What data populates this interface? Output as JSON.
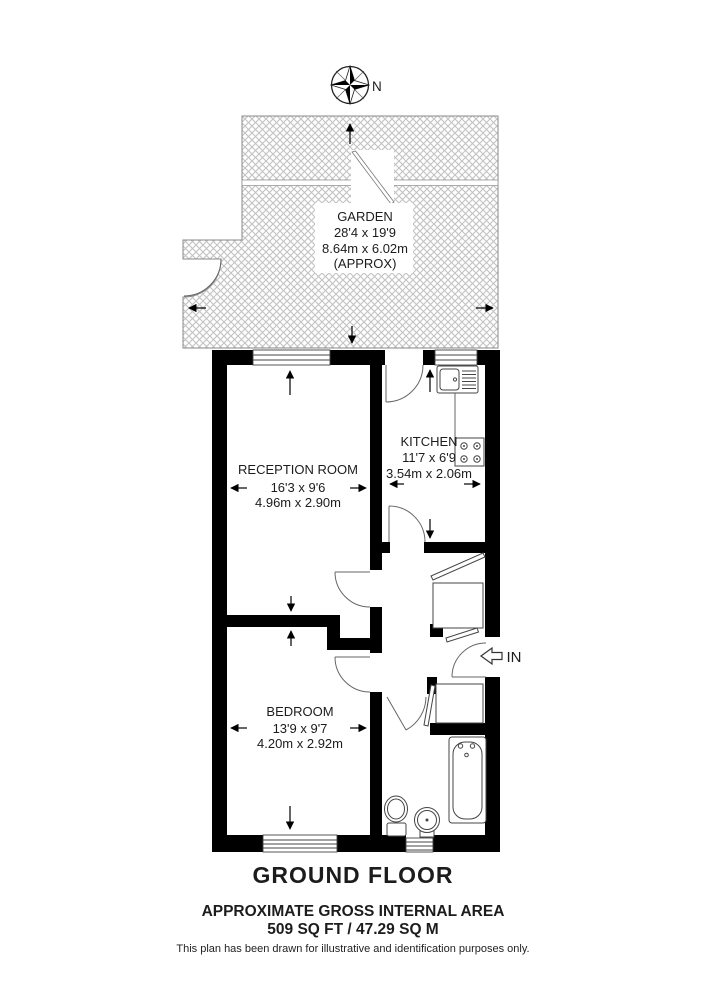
{
  "compass": {
    "north_label": "N"
  },
  "rooms": {
    "garden": {
      "name": "GARDEN",
      "dims_imperial": "28'4 x 19'9",
      "dims_metric": "8.64m x 6.02m",
      "note": "(APPROX)"
    },
    "reception": {
      "name": "RECEPTION ROOM",
      "dims_imperial": "16'3 x 9'6",
      "dims_metric": "4.96m x 2.90m"
    },
    "kitchen": {
      "name": "KITCHEN",
      "dims_imperial": "11'7 x 6'9",
      "dims_metric": "3.54m x 2.06m"
    },
    "bedroom": {
      "name": "BEDROOM",
      "dims_imperial": "13'9 x 9'7",
      "dims_metric": "4.20m x 2.92m"
    }
  },
  "entrance": {
    "label": "IN"
  },
  "footer": {
    "floor_label": "GROUND FLOOR",
    "area_heading": "APPROXIMATE GROSS INTERNAL AREA",
    "area_value": "509 SQ FT / 47.29 SQ M",
    "disclaimer": "This plan has been drawn for illustrative and identification purposes only."
  },
  "fixtures": {
    "kitchen_sink": "kitchen-sink-with-drainer",
    "hob": "four-ring-hob",
    "bath": "bath-tub",
    "toilet": "toilet",
    "basin": "wash-basin",
    "compass": "compass-rose"
  },
  "colors": {
    "wall": "#000000",
    "hatch": "#c2c2c2",
    "outline": "#555555",
    "background": "#ffffff"
  }
}
